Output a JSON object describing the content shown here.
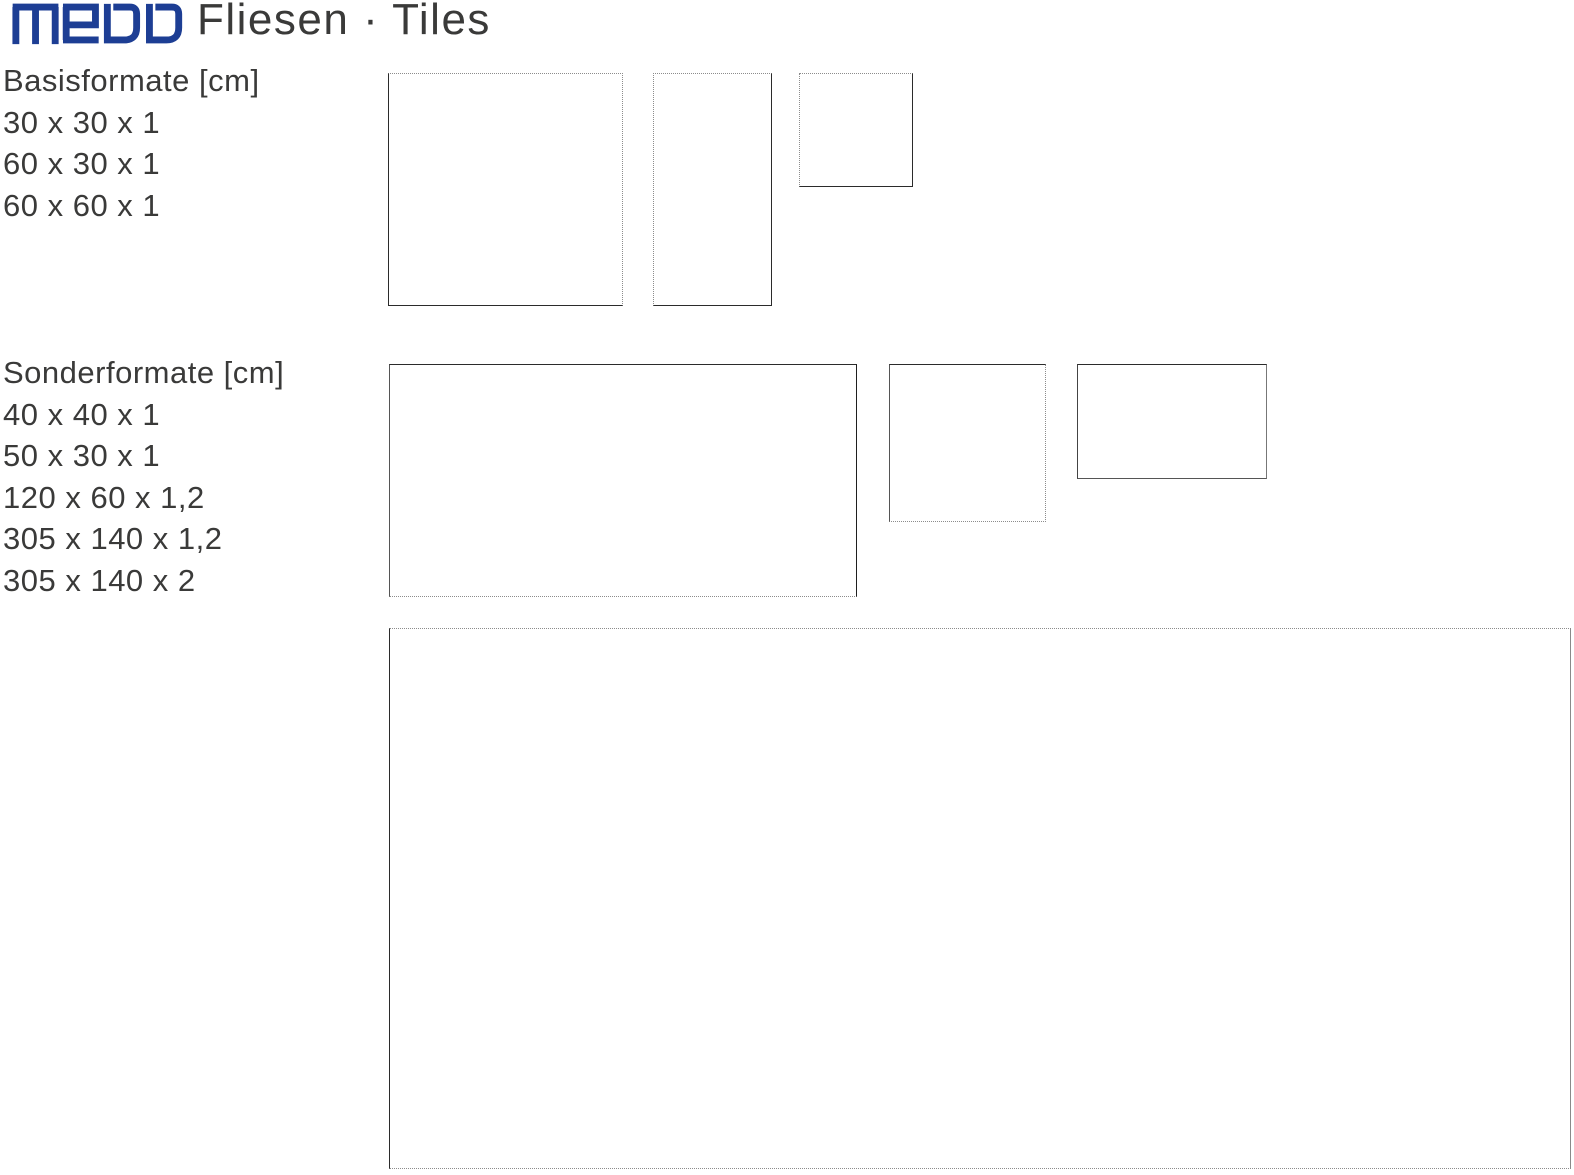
{
  "brand": {
    "logo_text": "medo",
    "logo_color": "#1d3e94"
  },
  "page_title": "Fliesen · Tiles",
  "sections": [
    {
      "id": "basisformate",
      "heading": "Basisformate [cm]",
      "sizes": [
        "30 x 30 x 1",
        "60 x 30 x 1",
        "60 x 60 x 1"
      ],
      "tiles": [
        "60 x 60",
        "60 x 30",
        "30 x 30"
      ]
    },
    {
      "id": "sonderformate",
      "heading": "Sonderformate [cm]",
      "sizes": [
        "40 x 40 x 1",
        "50 x 30 x 1",
        "120 x 60 x 1,2",
        "305 x 140 x 1,2",
        "305 x 140 x 2"
      ],
      "tiles": [
        "120 x 60",
        "40 x 40",
        "50 x 30",
        "305 x 140"
      ]
    }
  ],
  "colors": {
    "text": "#3a3a39",
    "line_solid": "#2b2b2b",
    "line_dotted": "#8c8c8c"
  }
}
